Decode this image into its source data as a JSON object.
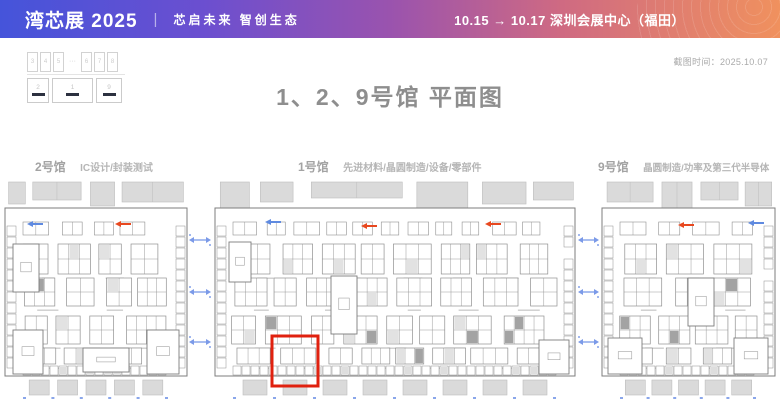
{
  "header": {
    "brand": "湾芯展 2025",
    "divider": "|",
    "slogan": "芯启未来  智创生态",
    "schedule": "10.15 → 10.17  深圳会展中心（福田）",
    "gradient": [
      "#4554da",
      "#6b4fd0",
      "#9a53ae",
      "#f0915e"
    ]
  },
  "meta": {
    "capture_time": "截图时间：2025.10.07"
  },
  "page_title": "1、2、9号馆 平面图",
  "minimap": {
    "top_halls": [
      "3",
      "4",
      "5",
      "6",
      "7",
      "8"
    ],
    "ellipsis": "···",
    "bottom_halls": [
      "2",
      "1",
      "9"
    ],
    "marker_color": "#2c3140"
  },
  "halls": [
    {
      "id": "2",
      "name": "2号馆",
      "category": "IC设计/封装测试"
    },
    {
      "id": "1",
      "name": "1号馆",
      "category": "先进材料/晶圆制造/设备/零部件"
    },
    {
      "id": "9",
      "name": "9号馆",
      "category": "晶圆制造/功率及第三代半导体"
    }
  ],
  "highlight": {
    "hall": "1号馆",
    "color": "#e0210f"
  },
  "colors": {
    "title_gray": "#8e8e8e",
    "hall_label_gray": "#b6b6b6",
    "plan_wall": "#7d7d7d",
    "booth_line": "#909090",
    "block_gray": "#dadada",
    "block_line": "#bdbdbd",
    "arrow_blue": "#5f8ae0",
    "connector_blue": "#7b9ae8",
    "gate_mark_blue": "#8aa6ea",
    "arrow_red": "#e8481f"
  }
}
